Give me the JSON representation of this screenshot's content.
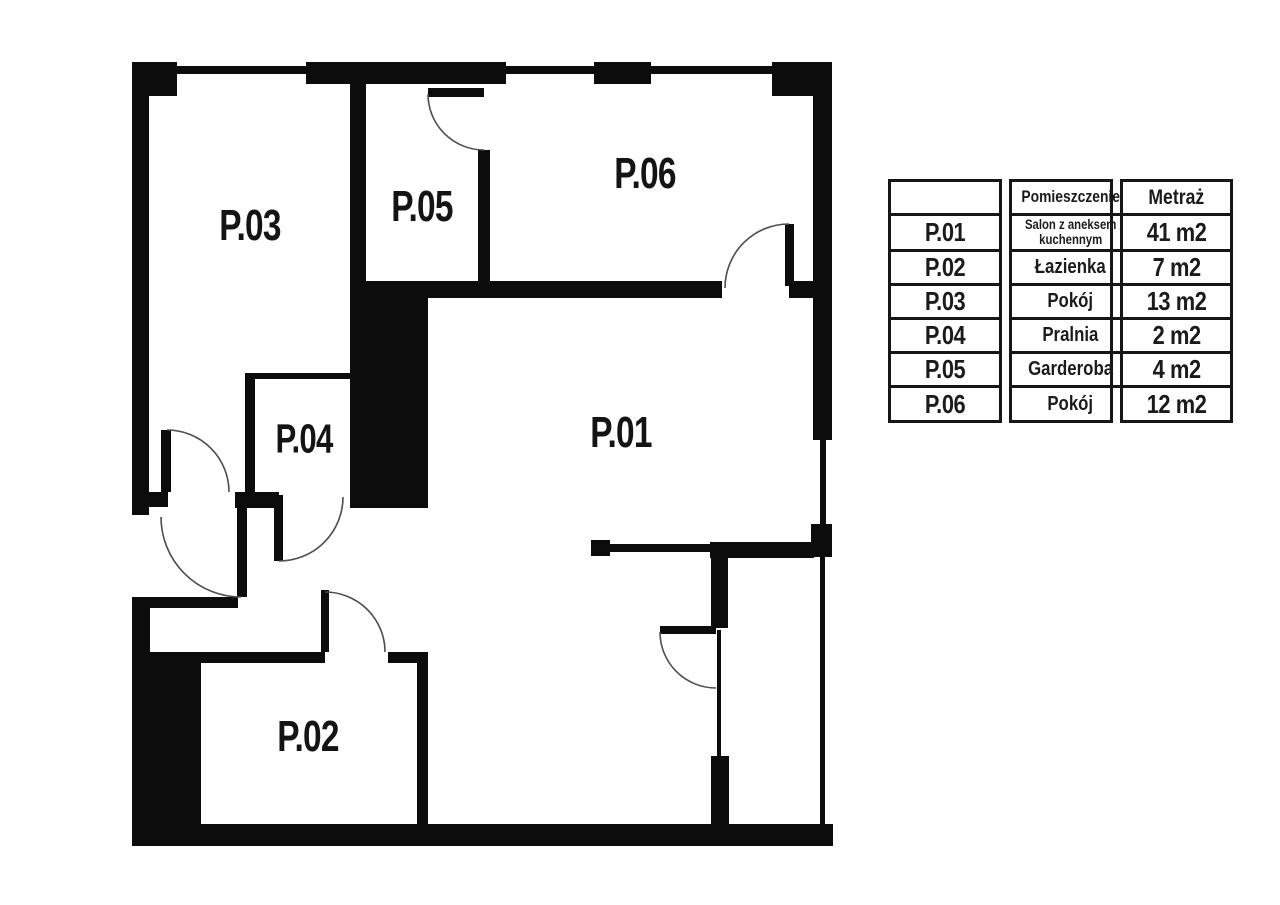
{
  "colors": {
    "wall": "#0c0c0c",
    "door_arc": "#4d4d4d",
    "background": "#ffffff",
    "text": "#1b1b1b"
  },
  "plan": {
    "rooms": [
      {
        "id": "p01",
        "label": "P.01"
      },
      {
        "id": "p02",
        "label": "P.02"
      },
      {
        "id": "p03",
        "label": "P.03"
      },
      {
        "id": "p04",
        "label": "P.04"
      },
      {
        "id": "p05",
        "label": "P.05"
      },
      {
        "id": "p06",
        "label": "P.06"
      }
    ]
  },
  "legend": {
    "headers": {
      "room": "",
      "name": "Pomieszczenie",
      "area": "Metraż"
    },
    "rows": [
      {
        "id": "P.01",
        "name": "Salon z aneksem kuchennym",
        "area": "41 m2"
      },
      {
        "id": "P.02",
        "name": "Łazienka",
        "area": "7 m2"
      },
      {
        "id": "P.03",
        "name": "Pokój",
        "area": "13 m2"
      },
      {
        "id": "P.04",
        "name": "Pralnia",
        "area": "2 m2"
      },
      {
        "id": "P.05",
        "name": "Garderoba",
        "area": "4 m2"
      },
      {
        "id": "P.06",
        "name": "Pokój",
        "area": "12 m2"
      }
    ]
  }
}
